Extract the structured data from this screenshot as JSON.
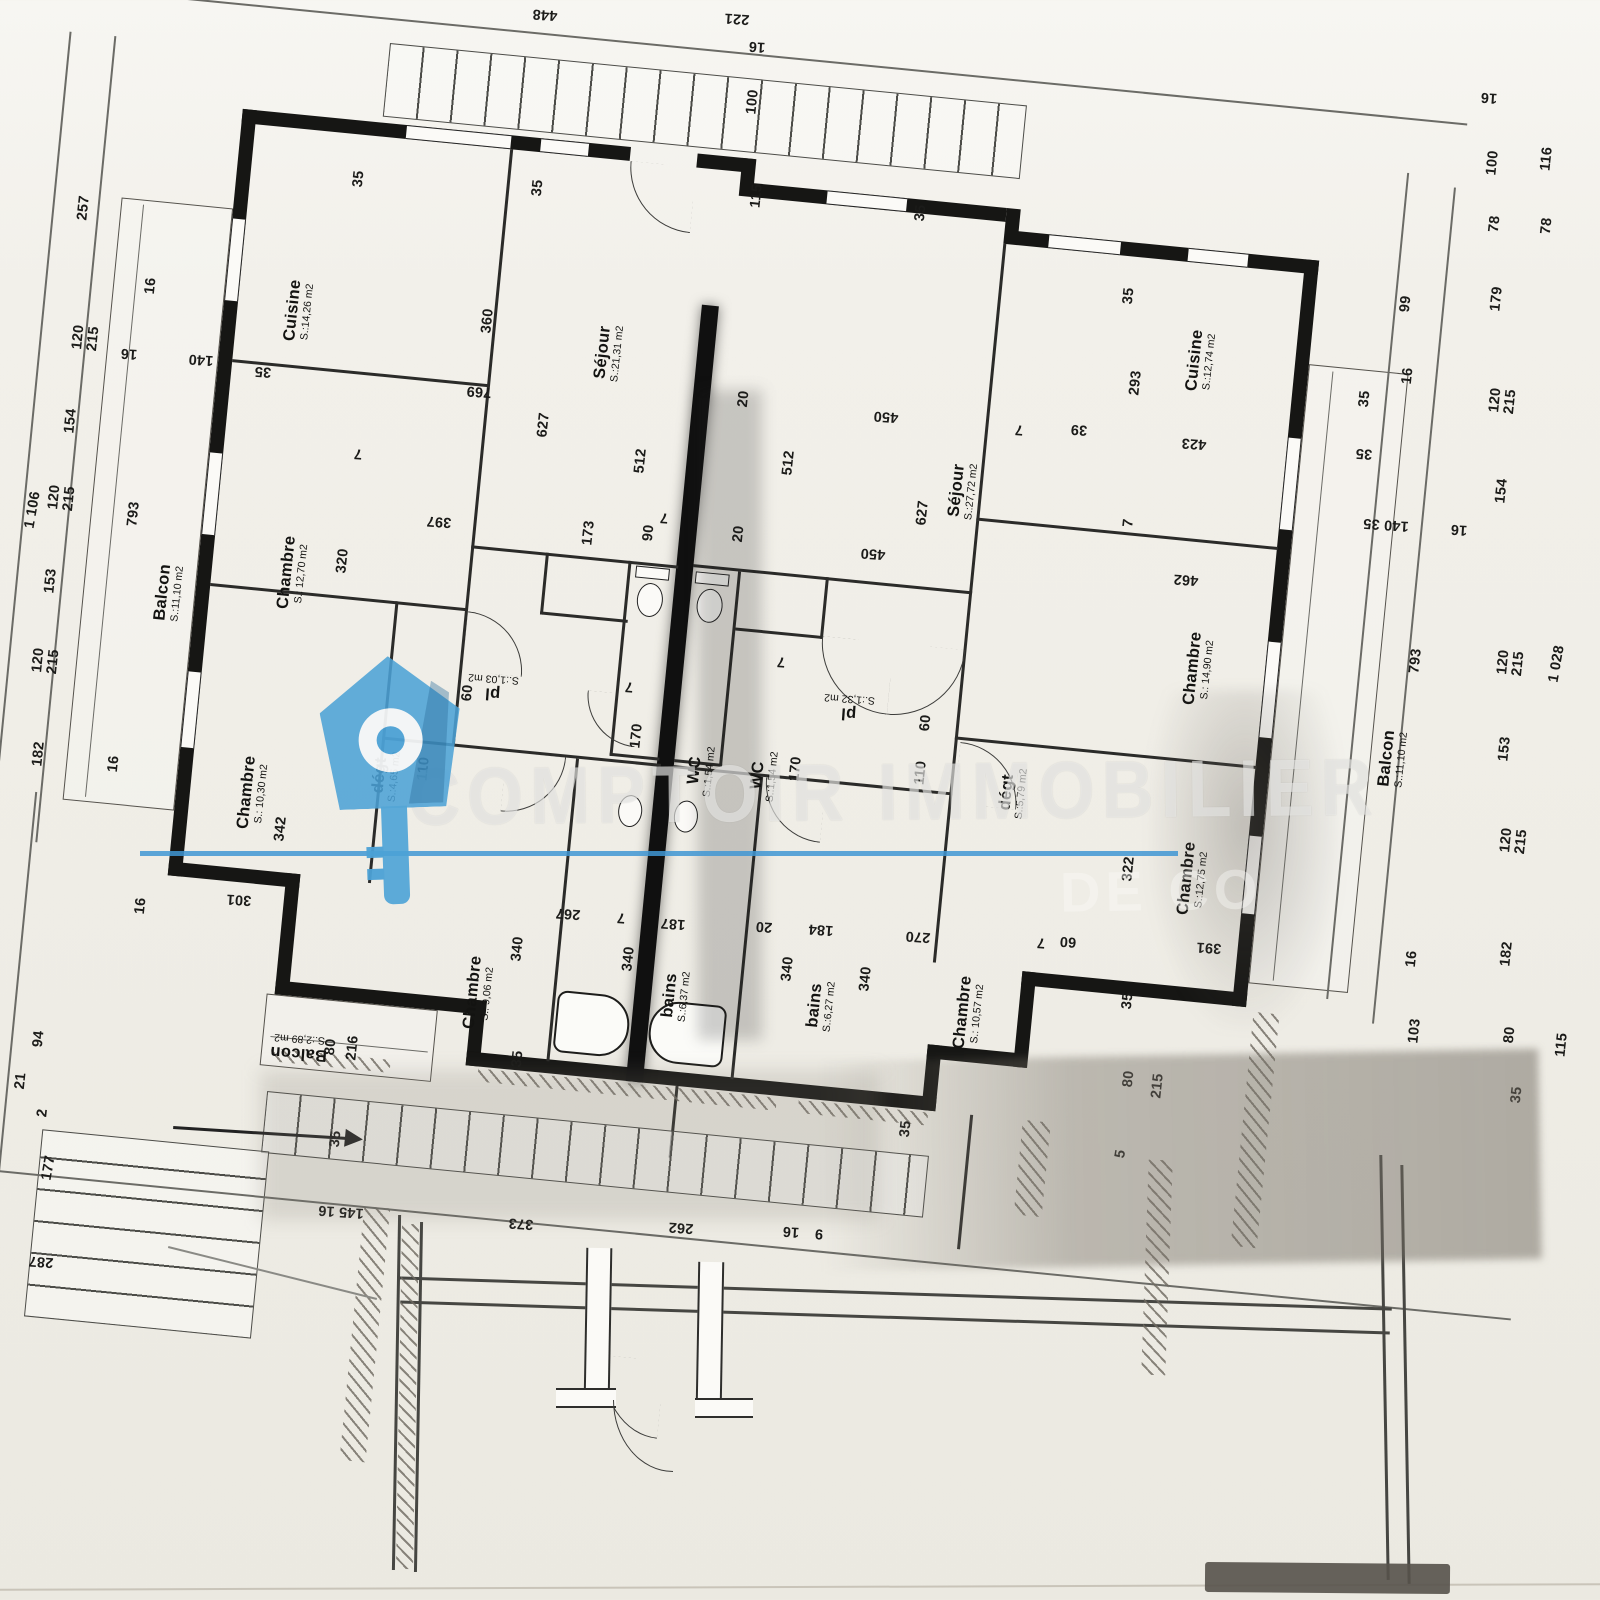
{
  "watermark": {
    "line1": "COMPTOIR IMMOBILIER",
    "line2_partial": "DE CO",
    "brand_blue": "#4CA2D6",
    "underline_blue": "#3F97D3"
  },
  "plan": {
    "type": "apartment-floor-plan",
    "units": "cm",
    "rooms": [
      {
        "name": "Cuisine",
        "area": "S.:14,26 m2",
        "x": 299,
        "y": 311,
        "r": -84
      },
      {
        "name": "Séjour",
        "area": "S.:21,31 m2",
        "x": 609,
        "y": 353,
        "r": -84
      },
      {
        "name": "Chambre",
        "area": "S.: 12,70 m2",
        "x": 293,
        "y": 573,
        "r": -84
      },
      {
        "name": "Balcon",
        "area": "S.:11,10 m2",
        "x": 169,
        "y": 593,
        "r": -84
      },
      {
        "name": "Chambre",
        "area": "S.: 10,30 m2",
        "x": 253,
        "y": 793,
        "r": -84
      },
      {
        "name": "dégt",
        "area": "S.:4,65 m2",
        "x": 386,
        "y": 776,
        "r": -84
      },
      {
        "name": "pl",
        "area": "S.:1,03 m2",
        "x": 493,
        "y": 687,
        "r": 184
      },
      {
        "name": "WC",
        "area": "S.:1,54 m2",
        "x": 701,
        "y": 771,
        "r": -84
      },
      {
        "name": "WC",
        "area": "S.:1,54 m2",
        "x": 764,
        "y": 776,
        "r": -84
      },
      {
        "name": "pl",
        "area": "S.:1,32 m2",
        "x": 849,
        "y": 707,
        "r": 184
      },
      {
        "name": "dégt",
        "area": "S.:5,79 m2",
        "x": 1013,
        "y": 793,
        "r": -84
      },
      {
        "name": "Cuisine",
        "area": "S.:12,74 m2",
        "x": 1201,
        "y": 361,
        "r": -84
      },
      {
        "name": "Séjour",
        "area": "S.:27,72 m2",
        "x": 963,
        "y": 491,
        "r": -84
      },
      {
        "name": "Chambre",
        "area": "S.: 14,90 m2",
        "x": 1199,
        "y": 669,
        "r": -84
      },
      {
        "name": "Chambre",
        "area": "S.:12,75 m2",
        "x": 1193,
        "y": 879,
        "r": -84
      },
      {
        "name": "Chambre",
        "area": "S.: 9,06 m2",
        "x": 479,
        "y": 993,
        "r": -84
      },
      {
        "name": "bains",
        "area": "S.:6,37 m2",
        "x": 676,
        "y": 996,
        "r": -84
      },
      {
        "name": "bains",
        "area": "S.:6,27 m2",
        "x": 821,
        "y": 1006,
        "r": -84
      },
      {
        "name": "Chambre",
        "area": "S.: 10,57 m2",
        "x": 969,
        "y": 1013,
        "r": -84
      },
      {
        "name": "Balcon",
        "area": "S.:11,10 m2",
        "x": 1393,
        "y": 759,
        "r": -84
      },
      {
        "name": "Balcon",
        "area": "S.:2,89 m2",
        "x": 299,
        "y": 1047,
        "r": 184
      }
    ],
    "dims": [
      {
        "v": "448",
        "x": 545,
        "y": 14,
        "r": 184
      },
      {
        "v": "221",
        "x": 737,
        "y": 18,
        "r": 184
      },
      {
        "v": "16",
        "x": 757,
        "y": 46,
        "r": 184
      },
      {
        "v": "100",
        "x": 753,
        "y": 102,
        "r": -84
      },
      {
        "v": "115",
        "x": 757,
        "y": 196,
        "r": -84
      },
      {
        "v": "35",
        "x": 921,
        "y": 213,
        "r": -84
      },
      {
        "v": "35",
        "x": 359,
        "y": 179,
        "r": -84
      },
      {
        "v": "35",
        "x": 538,
        "y": 188,
        "r": -84
      },
      {
        "v": "257",
        "x": 84,
        "y": 208,
        "r": -84
      },
      {
        "v": "16",
        "x": 151,
        "y": 286,
        "r": -84
      },
      {
        "v": "140",
        "x": 201,
        "y": 359,
        "r": 184
      },
      {
        "v": "16",
        "x": 129,
        "y": 353,
        "r": 184
      },
      {
        "v": "35",
        "x": 263,
        "y": 371,
        "r": 184
      },
      {
        "v": "1 106",
        "x": 33,
        "y": 510,
        "r": -80
      },
      {
        "v": "154",
        "x": 71,
        "y": 421,
        "r": -84
      },
      {
        "v": "120\n215",
        "x": 86,
        "y": 338,
        "r": -84
      },
      {
        "v": "120\n215",
        "x": 62,
        "y": 498,
        "r": -84
      },
      {
        "v": "153",
        "x": 51,
        "y": 581,
        "r": -84
      },
      {
        "v": "120\n215",
        "x": 46,
        "y": 661,
        "r": -84
      },
      {
        "v": "182",
        "x": 39,
        "y": 754,
        "r": -84
      },
      {
        "v": "16",
        "x": 114,
        "y": 764,
        "r": -84
      },
      {
        "v": "793",
        "x": 134,
        "y": 514,
        "r": -84
      },
      {
        "v": "16",
        "x": 141,
        "y": 906,
        "r": -84
      },
      {
        "v": "94",
        "x": 39,
        "y": 1039,
        "r": -84
      },
      {
        "v": "21",
        "x": 21,
        "y": 1081,
        "r": -84
      },
      {
        "v": "2",
        "x": 43,
        "y": 1113,
        "r": -84
      },
      {
        "v": "177",
        "x": 49,
        "y": 1168,
        "r": -80
      },
      {
        "v": "287",
        "x": 41,
        "y": 1261,
        "r": 184
      },
      {
        "v": "360",
        "x": 488,
        "y": 321,
        "r": -84
      },
      {
        "v": "769",
        "x": 479,
        "y": 391,
        "r": 184
      },
      {
        "v": "627",
        "x": 544,
        "y": 425,
        "r": -84
      },
      {
        "v": "512",
        "x": 641,
        "y": 461,
        "r": -84
      },
      {
        "v": "20",
        "x": 744,
        "y": 399,
        "r": -84
      },
      {
        "v": "450",
        "x": 886,
        "y": 416,
        "r": 184
      },
      {
        "v": "39",
        "x": 1079,
        "y": 429,
        "r": 184
      },
      {
        "v": "7",
        "x": 1019,
        "y": 429,
        "r": 184
      },
      {
        "v": "173",
        "x": 589,
        "y": 533,
        "r": -84
      },
      {
        "v": "90",
        "x": 649,
        "y": 533,
        "r": -84
      },
      {
        "v": "20",
        "x": 739,
        "y": 534,
        "r": -84
      },
      {
        "v": "7",
        "x": 664,
        "y": 517,
        "r": 184
      },
      {
        "v": "512",
        "x": 789,
        "y": 463,
        "r": -84
      },
      {
        "v": "627",
        "x": 923,
        "y": 513,
        "r": -84
      },
      {
        "v": "450",
        "x": 873,
        "y": 553,
        "r": 184
      },
      {
        "v": "293",
        "x": 1136,
        "y": 383,
        "r": -84
      },
      {
        "v": "35",
        "x": 1129,
        "y": 296,
        "r": -84
      },
      {
        "v": "423",
        "x": 1194,
        "y": 443,
        "r": 184
      },
      {
        "v": "35",
        "x": 1364,
        "y": 453,
        "r": 184
      },
      {
        "v": "99",
        "x": 1406,
        "y": 304,
        "r": -84
      },
      {
        "v": "16",
        "x": 1408,
        "y": 376,
        "r": -84
      },
      {
        "v": "7",
        "x": 1129,
        "y": 523,
        "r": -84
      },
      {
        "v": "462",
        "x": 1186,
        "y": 579,
        "r": 184
      },
      {
        "v": "397",
        "x": 439,
        "y": 521,
        "r": 184
      },
      {
        "v": "320",
        "x": 343,
        "y": 561,
        "r": -84
      },
      {
        "v": "7",
        "x": 358,
        "y": 453,
        "r": 184
      },
      {
        "v": "16",
        "x": 1489,
        "y": 97,
        "r": 184
      },
      {
        "v": "100",
        "x": 1493,
        "y": 163,
        "r": -84
      },
      {
        "v": "78",
        "x": 1495,
        "y": 224,
        "r": -84
      },
      {
        "v": "116",
        "x": 1547,
        "y": 159,
        "r": -84
      },
      {
        "v": "78",
        "x": 1547,
        "y": 226,
        "r": -84
      },
      {
        "v": "179",
        "x": 1497,
        "y": 299,
        "r": -84
      },
      {
        "v": "120\n215",
        "x": 1503,
        "y": 401,
        "r": -84
      },
      {
        "v": "154",
        "x": 1502,
        "y": 491,
        "r": -84
      },
      {
        "v": "35",
        "x": 1365,
        "y": 399,
        "r": -84
      },
      {
        "v": "140 35",
        "x": 1386,
        "y": 524,
        "r": 184
      },
      {
        "v": "16",
        "x": 1459,
        "y": 529,
        "r": 184
      },
      {
        "v": "793",
        "x": 1416,
        "y": 661,
        "r": -84
      },
      {
        "v": "120\n215",
        "x": 1511,
        "y": 663,
        "r": -84
      },
      {
        "v": "153",
        "x": 1505,
        "y": 749,
        "r": -84
      },
      {
        "v": "120\n215",
        "x": 1514,
        "y": 841,
        "r": -84
      },
      {
        "v": "182",
        "x": 1507,
        "y": 954,
        "r": -84
      },
      {
        "v": "16",
        "x": 1412,
        "y": 959,
        "r": -84
      },
      {
        "v": "103",
        "x": 1415,
        "y": 1031,
        "r": -84
      },
      {
        "v": "80",
        "x": 1510,
        "y": 1035,
        "r": -84
      },
      {
        "v": "115",
        "x": 1562,
        "y": 1045,
        "r": -84
      },
      {
        "v": "1 028",
        "x": 1557,
        "y": 664,
        "r": -80
      },
      {
        "v": "35",
        "x": 1517,
        "y": 1095,
        "r": -84
      },
      {
        "v": "340",
        "x": 518,
        "y": 949,
        "r": -84
      },
      {
        "v": "267",
        "x": 568,
        "y": 913,
        "r": 184
      },
      {
        "v": "7",
        "x": 621,
        "y": 917,
        "r": 184
      },
      {
        "v": "187",
        "x": 673,
        "y": 923,
        "r": 184
      },
      {
        "v": "340",
        "x": 629,
        "y": 959,
        "r": -84
      },
      {
        "v": "20",
        "x": 764,
        "y": 926,
        "r": 184
      },
      {
        "v": "184",
        "x": 821,
        "y": 929,
        "r": 184
      },
      {
        "v": "340",
        "x": 788,
        "y": 969,
        "r": -84
      },
      {
        "v": "35",
        "x": 518,
        "y": 1059,
        "r": -84
      },
      {
        "v": "340",
        "x": 866,
        "y": 979,
        "r": -84
      },
      {
        "v": "270",
        "x": 918,
        "y": 936,
        "r": 184
      },
      {
        "v": "7",
        "x": 1041,
        "y": 942,
        "r": 184
      },
      {
        "v": "60",
        "x": 1068,
        "y": 941,
        "r": 184
      },
      {
        "v": "322",
        "x": 1129,
        "y": 869,
        "r": -84
      },
      {
        "v": "391",
        "x": 1209,
        "y": 947,
        "r": 184
      },
      {
        "v": "35",
        "x": 1128,
        "y": 1001,
        "r": -84
      },
      {
        "v": "80",
        "x": 1129,
        "y": 1079,
        "r": -84
      },
      {
        "v": "215",
        "x": 1158,
        "y": 1086,
        "r": -84
      },
      {
        "v": "5",
        "x": 1121,
        "y": 1154,
        "r": -80
      },
      {
        "v": "342",
        "x": 281,
        "y": 829,
        "r": -84
      },
      {
        "v": "301",
        "x": 239,
        "y": 899,
        "r": 184
      },
      {
        "v": "110",
        "x": 424,
        "y": 769,
        "r": -84
      },
      {
        "v": "60",
        "x": 468,
        "y": 693,
        "r": -84
      },
      {
        "v": "170",
        "x": 637,
        "y": 736,
        "r": -84
      },
      {
        "v": "7",
        "x": 629,
        "y": 686,
        "r": 184
      },
      {
        "v": "170",
        "x": 796,
        "y": 769,
        "r": -84
      },
      {
        "v": "7",
        "x": 781,
        "y": 661,
        "r": 184
      },
      {
        "v": "110",
        "x": 921,
        "y": 773,
        "r": -84
      },
      {
        "v": "60",
        "x": 926,
        "y": 723,
        "r": -84
      },
      {
        "v": "145 16",
        "x": 341,
        "y": 1211,
        "r": 184
      },
      {
        "v": "373",
        "x": 521,
        "y": 1223,
        "r": 184
      },
      {
        "v": "262",
        "x": 681,
        "y": 1227,
        "r": 184
      },
      {
        "v": "16",
        "x": 791,
        "y": 1231,
        "r": 184
      },
      {
        "v": "9",
        "x": 819,
        "y": 1233,
        "r": 184
      },
      {
        "v": "35",
        "x": 906,
        "y": 1129,
        "r": -84
      },
      {
        "v": "35",
        "x": 336,
        "y": 1139,
        "r": -84
      },
      {
        "v": "216",
        "x": 353,
        "y": 1048,
        "r": -84
      },
      {
        "v": "80",
        "x": 331,
        "y": 1047,
        "r": -84
      }
    ]
  }
}
